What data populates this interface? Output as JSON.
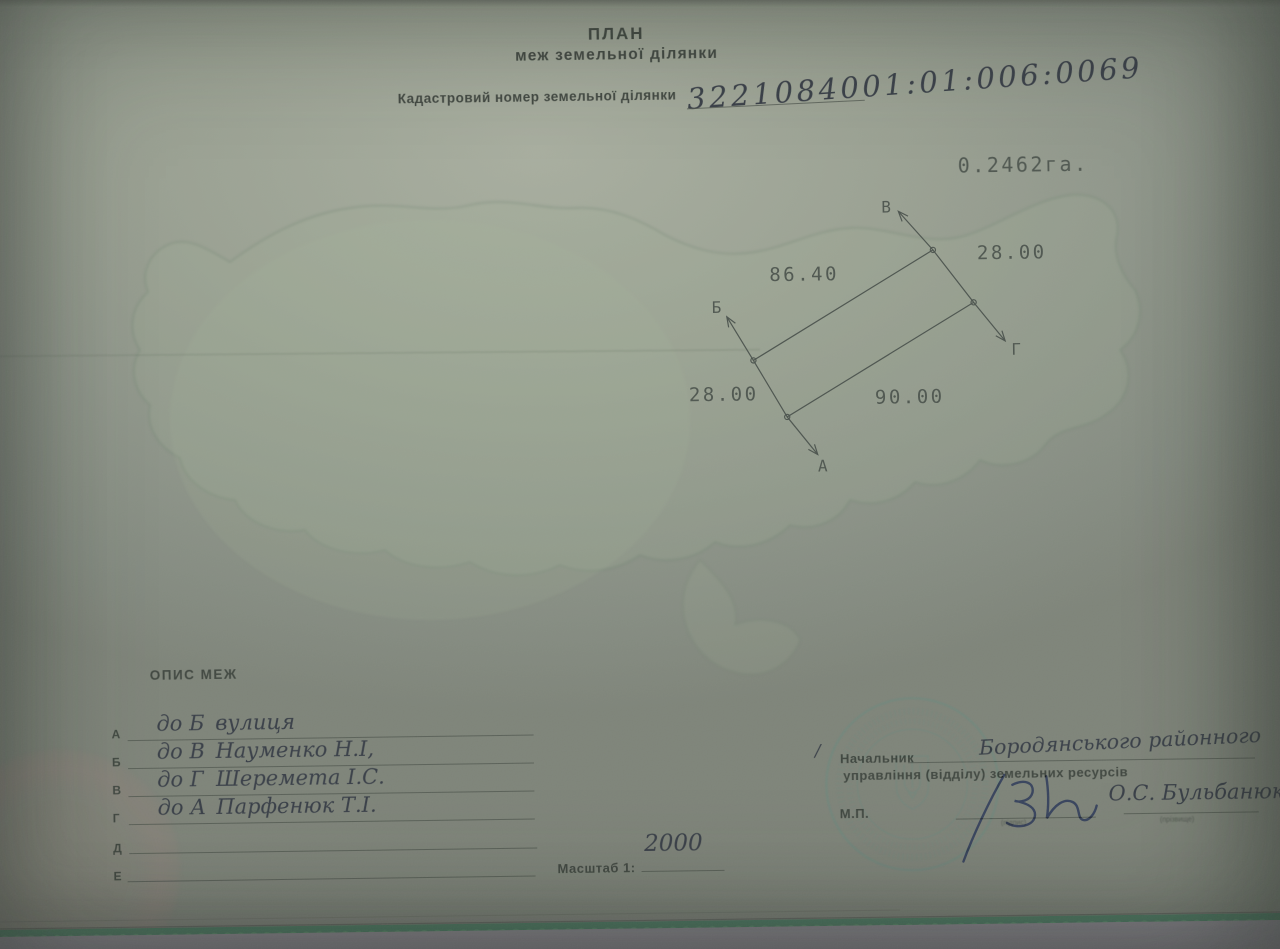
{
  "document": {
    "title": "ПЛАН",
    "subtitle": "меж земельної ділянки",
    "cadastral_label": "Кадастровий номер земельної ділянки",
    "cadastral_number": "3221084001:01:006:0069",
    "area": "0.2462га."
  },
  "diagram": {
    "corners": {
      "a": "А",
      "b": "Б",
      "v": "В",
      "g": "Г"
    },
    "dimensions": {
      "side_b_v": "86.40",
      "side_v_g": "28.00",
      "side_a_b": "28.00",
      "side_g_a": "90.00"
    }
  },
  "boundaries": {
    "heading": "ОПИС МЕЖ",
    "rows": [
      {
        "letter": "А",
        "dir": "до Б",
        "name": "вулиця"
      },
      {
        "letter": "Б",
        "dir": "до В",
        "name": "Науменко Н.І,"
      },
      {
        "letter": "В",
        "dir": "до Г",
        "name": "Шеремета І.С."
      },
      {
        "letter": "Г",
        "dir": "до А",
        "name": "Парфенюк Т.І."
      },
      {
        "letter": "Д",
        "dir": "",
        "name": ""
      },
      {
        "letter": "Е",
        "dir": "",
        "name": ""
      }
    ]
  },
  "scale": {
    "label": "Масштаб 1:",
    "value": "2000"
  },
  "approval": {
    "mark": "/",
    "position_line1": "Начальник",
    "position_line2": "управління (відділу) земельних ресурсів",
    "office": "Бородянського районного",
    "seal_abbr": "М.П.",
    "signature_caption": "(підпис)",
    "name": "О.С. Бульбанюк",
    "name_caption": "(прізвище)"
  },
  "colors": {
    "paper": "#959c90",
    "print_ink": "#3e453e",
    "hand_ink": "#363c45",
    "signature_ink": "#2d3a58",
    "stamp": "#5d8a80",
    "edge_green": "#3f7a5c"
  }
}
